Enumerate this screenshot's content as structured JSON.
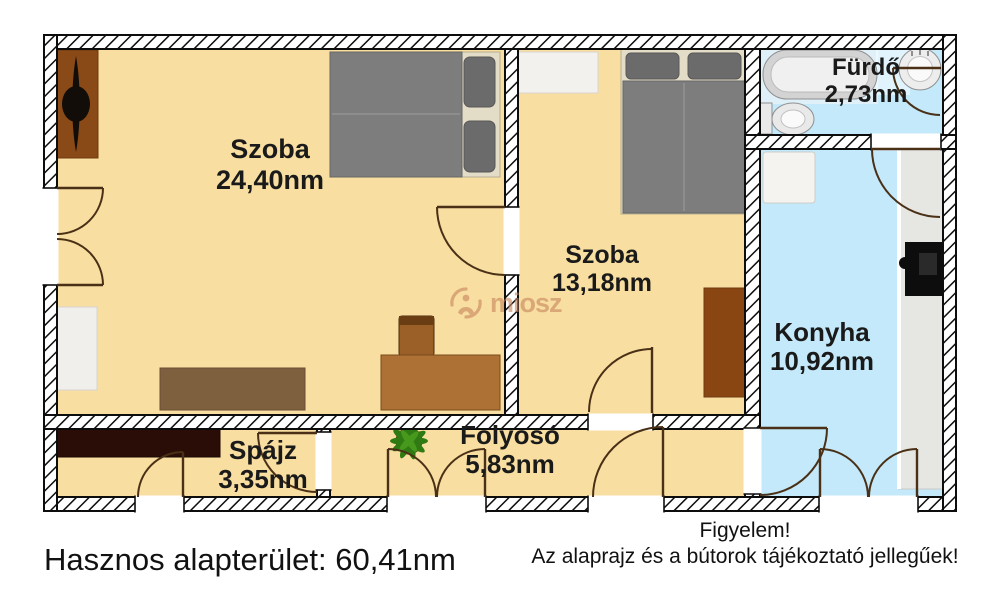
{
  "rooms": [
    {
      "id": "szoba-1",
      "name": "Szoba",
      "area": "24,40nm"
    },
    {
      "id": "szoba-2",
      "name": "Szoba",
      "area": "13,18nm"
    },
    {
      "id": "furdo",
      "name": "Fürdő",
      "area": "2,73nm"
    },
    {
      "id": "konyha",
      "name": "Konyha",
      "area": "10,92nm"
    },
    {
      "id": "spajz",
      "name": "Spájz",
      "area": "3,35nm"
    },
    {
      "id": "folyoso",
      "name": "Folyosó",
      "area": "5,83nm"
    }
  ],
  "footer": {
    "total_area": "Hasznos alapterület: 60,41nm",
    "notice_line1": "Figyelem!",
    "notice_line2": "Az alaprajz és a bútorok tájékoztató jellegűek!"
  },
  "watermark": {
    "text": "miosz"
  },
  "colors": {
    "floor_warm": "#F8DEA0",
    "floor_cool": "#C3E9FA",
    "wall_line": "#0d0d0d",
    "door_line": "#4a3016",
    "accent_watermark": "#c8875f",
    "text": "#1a1a1a"
  }
}
